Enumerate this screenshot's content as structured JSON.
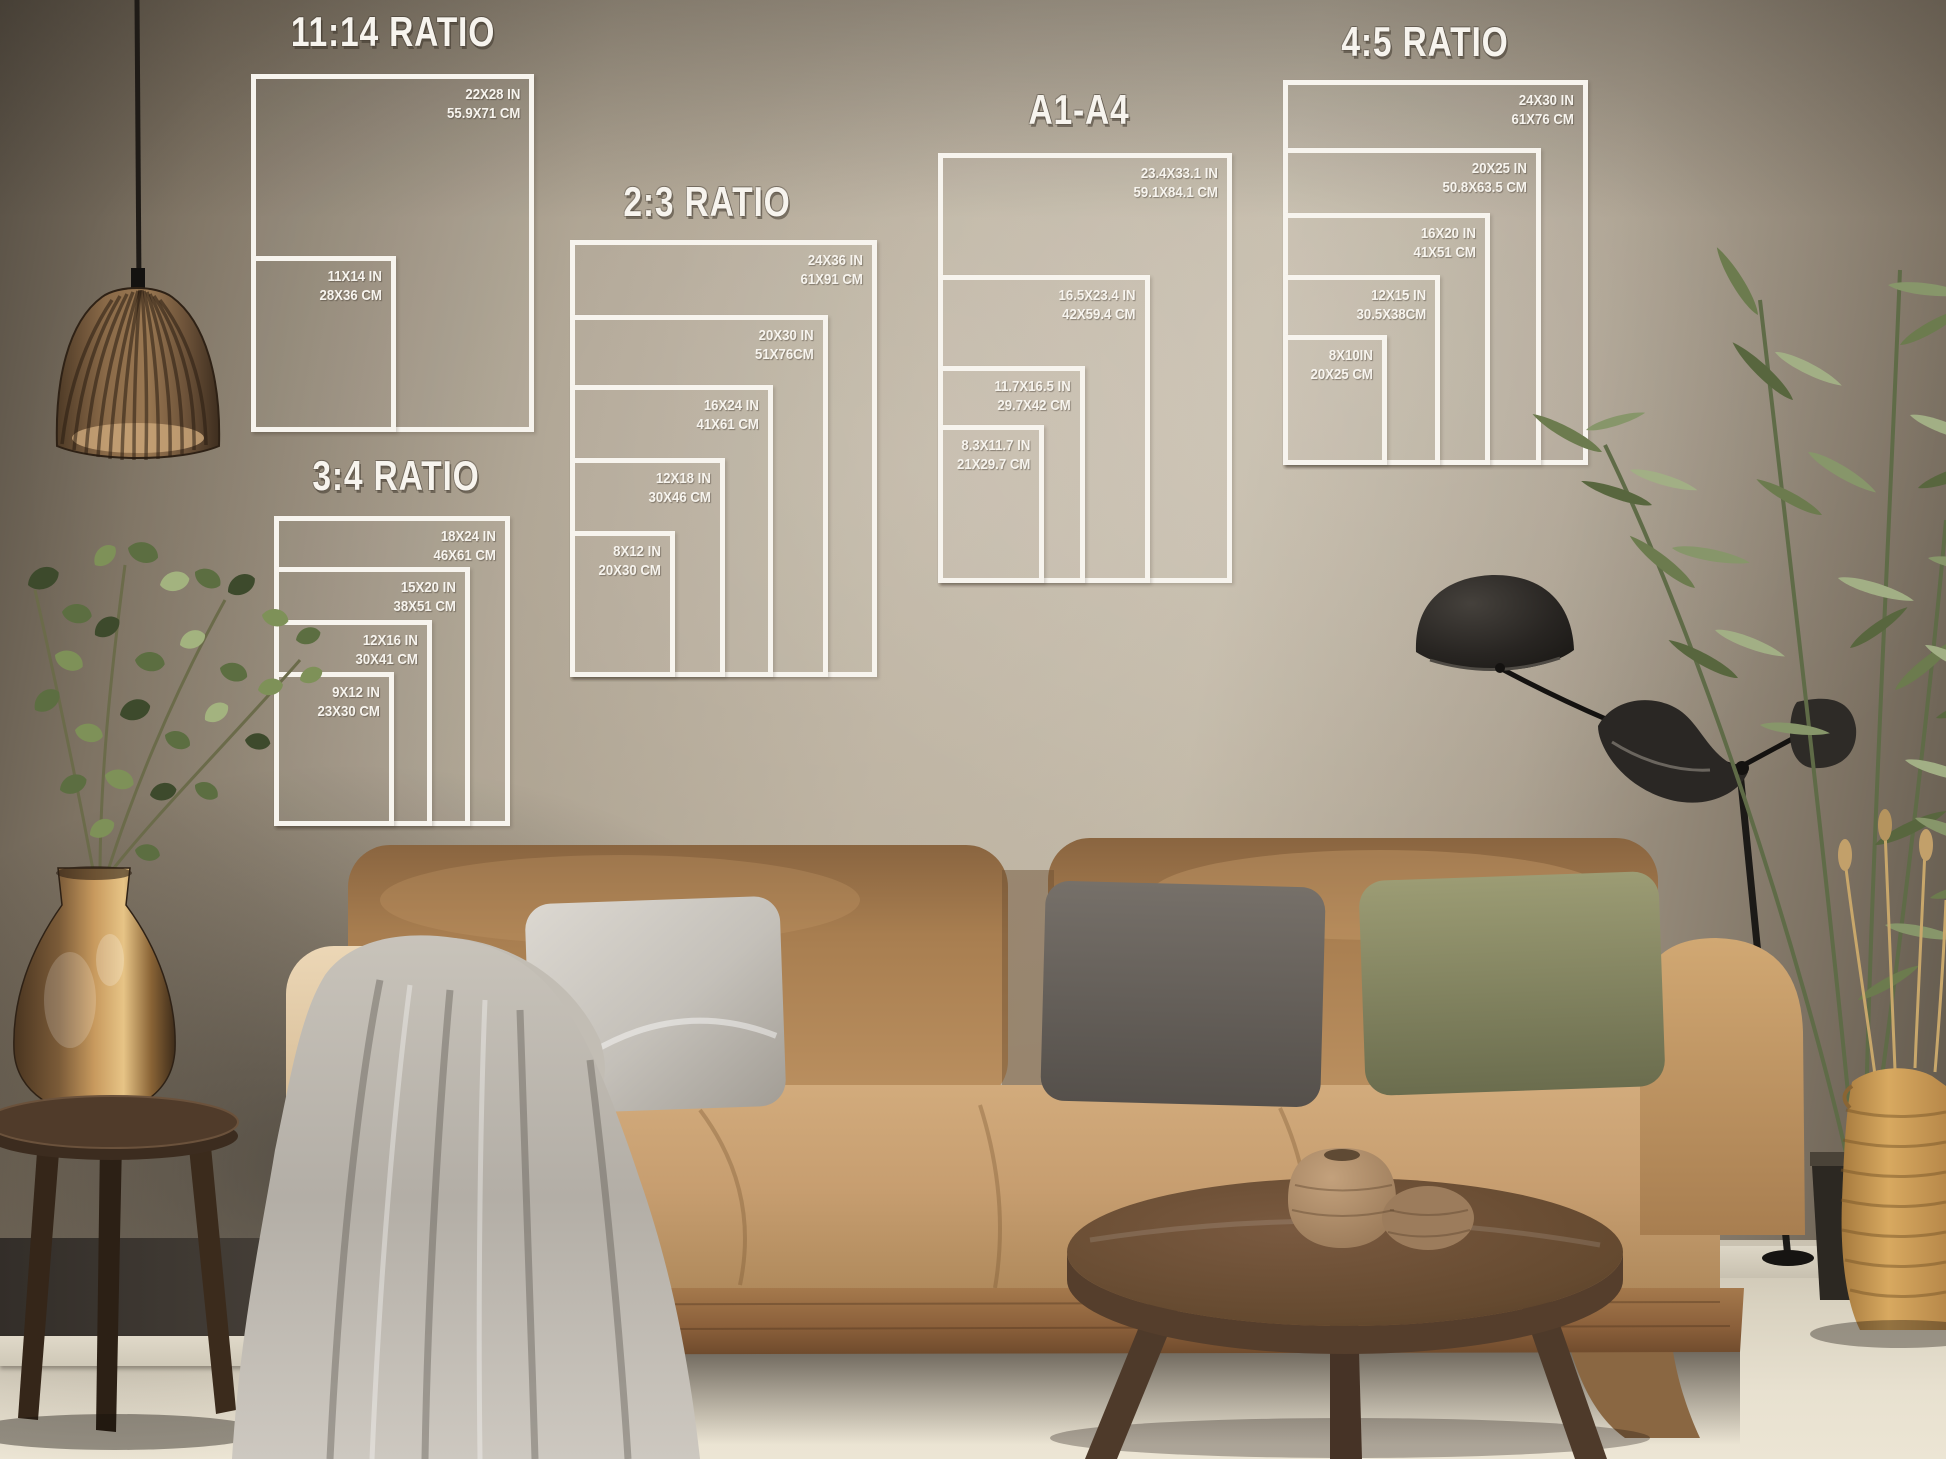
{
  "palette": {
    "overlay-line": "#f7f4ee",
    "wall-light": "#c3b9a9",
    "wall-dark": "#5e564a",
    "sofa-tan": "#c09a6c",
    "sofa-back": "#a37a4c",
    "pillow-silver": "#cdc9c2",
    "pillow-gray": "#6b6460",
    "pillow-olive": "#8b8b64",
    "blanket-gray": "#bdb8af",
    "wood-table": "#64492f",
    "copper-vase": "#c59a62",
    "plant-green": "#7d8f5c",
    "floor": "#e3dccb",
    "lamp-black": "#232019"
  },
  "groups": [
    {
      "title": "11:14 RATIO",
      "sizes": [
        {
          "in": "22X28 IN",
          "cm": "55.9X71 CM"
        },
        {
          "in": "11X14 IN",
          "cm": "28X36 CM"
        }
      ]
    },
    {
      "title": "3:4 RATIO",
      "sizes": [
        {
          "in": "18X24 IN",
          "cm": "46X61 CM"
        },
        {
          "in": "15X20 IN",
          "cm": "38X51 CM"
        },
        {
          "in": "12X16 IN",
          "cm": "30X41 CM"
        },
        {
          "in": "9X12 IN",
          "cm": "23X30 CM"
        }
      ]
    },
    {
      "title": "2:3 RATIO",
      "sizes": [
        {
          "in": "24X36 IN",
          "cm": "61X91 CM"
        },
        {
          "in": "20X30 IN",
          "cm": "51X76CM"
        },
        {
          "in": "16X24 IN",
          "cm": "41X61 CM"
        },
        {
          "in": "12X18 IN",
          "cm": "30X46 CM"
        },
        {
          "in": "8X12 IN",
          "cm": "20X30 CM"
        }
      ]
    },
    {
      "title": "A1-A4",
      "sizes": [
        {
          "in": "23.4X33.1 IN",
          "cm": "59.1X84.1 CM"
        },
        {
          "in": "16.5X23.4 IN",
          "cm": "42X59.4 CM"
        },
        {
          "in": "11.7X16.5 IN",
          "cm": "29.7X42 CM"
        },
        {
          "in": "8.3X11.7 IN",
          "cm": "21X29.7 CM"
        }
      ]
    },
    {
      "title": "4:5 RATIO",
      "sizes": [
        {
          "in": "24X30 IN",
          "cm": "61X76 CM"
        },
        {
          "in": "20X25 IN",
          "cm": "50.8X63.5 CM"
        },
        {
          "in": "16X20 IN",
          "cm": "41X51 CM"
        },
        {
          "in": "12X15 IN",
          "cm": "30.5X38CM"
        },
        {
          "in": "8X10IN",
          "cm": "20X25 CM"
        }
      ]
    }
  ]
}
